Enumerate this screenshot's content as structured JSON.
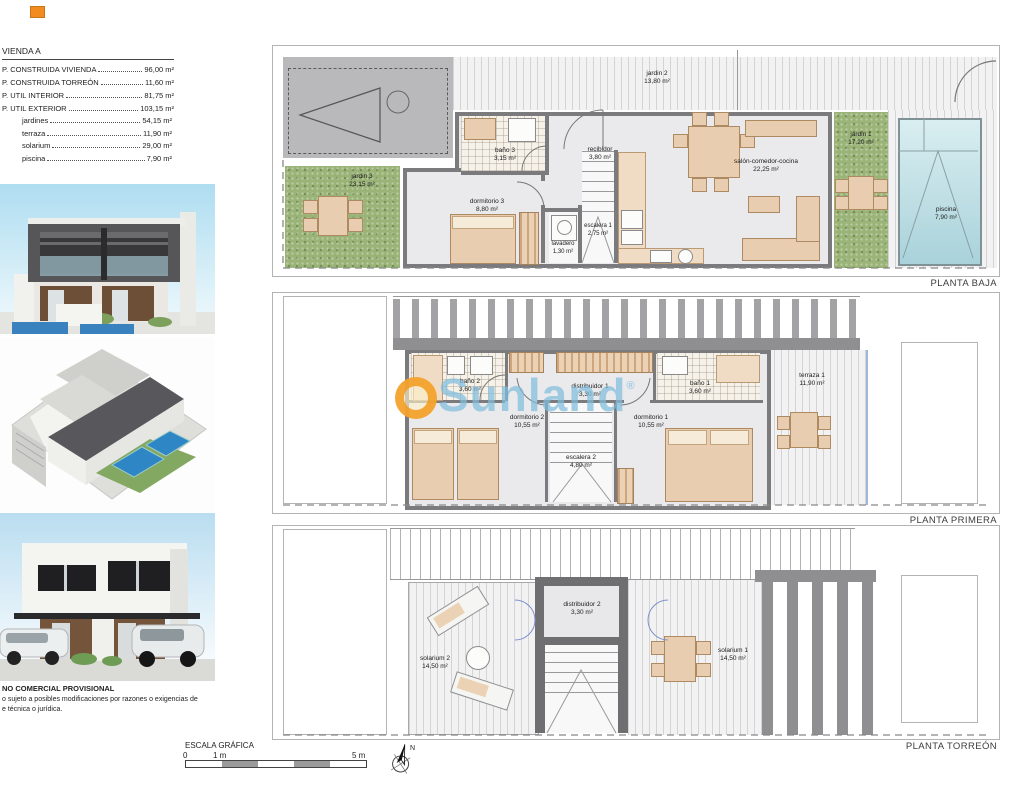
{
  "legend": {
    "title": "VIENDA A",
    "rows": [
      {
        "label": "P. CONSTRUIDA VIVIENDA",
        "value": "96,00 m²"
      },
      {
        "label": "P. CONSTRUIDA TORREÓN",
        "value": "11,60 m²"
      },
      {
        "label": "P. UTIL INTERIOR",
        "value": "81,75 m²"
      },
      {
        "label": "P. UTIL EXTERIOR",
        "value": "103,15 m²"
      }
    ],
    "subrows": [
      {
        "label": "jardines",
        "value": "54,15 m²"
      },
      {
        "label": "terraza",
        "value": "11,90 m²"
      },
      {
        "label": "solarium",
        "value": "29,00 m²"
      },
      {
        "label": "piscina",
        "value": "7,90 m²"
      }
    ]
  },
  "floors": [
    {
      "label": "PLANTA BAJA",
      "rooms": [
        {
          "name": "jardin 2",
          "area": "13,80 m²"
        },
        {
          "name": "jardin 3",
          "area": "23,15 m²"
        },
        {
          "name": "baño 3",
          "area": "3,15 m²"
        },
        {
          "name": "recibidor",
          "area": "3,80 m²"
        },
        {
          "name": "dormitorio 3",
          "area": "8,80 m²"
        },
        {
          "name": "lavadero",
          "area": "1,30 m²"
        },
        {
          "name": "escalera 1",
          "area": "2,75 m²"
        },
        {
          "name": "salón-comedor-cocina",
          "area": "22,25 m²"
        },
        {
          "name": "jardin 1",
          "area": "17,20 m²"
        },
        {
          "name": "piscina",
          "area": "7,90 m²"
        }
      ]
    },
    {
      "label": "PLANTA PRIMERA",
      "rooms": [
        {
          "name": "baño 2",
          "area": "3,60 m²"
        },
        {
          "name": "distribuidor 1",
          "area": "3,30 m²"
        },
        {
          "name": "baño 1",
          "area": "3,60 m²"
        },
        {
          "name": "dormitorio 2",
          "area": "10,55 m²"
        },
        {
          "name": "dormitorio 1",
          "area": "10,55 m²"
        },
        {
          "name": "escalera 2",
          "area": "4,80 m²"
        },
        {
          "name": "terraza 1",
          "area": "11,90 m²"
        }
      ]
    },
    {
      "label": "PLANTA TORREÓN",
      "rooms": [
        {
          "name": "solarium 2",
          "area": "14,50 m²"
        },
        {
          "name": "distribuidor 2",
          "area": "3,30 m²"
        },
        {
          "name": "solarium 1",
          "area": "14,50 m²"
        }
      ]
    }
  ],
  "watermark": {
    "text": "Sunland",
    "registered": "®"
  },
  "scalebar": {
    "title": "ESCALA GRÁFICA",
    "tick0": "0",
    "tick1": "1 m",
    "tick5": "5 m"
  },
  "compass": {
    "north": "N"
  },
  "disclaimer": {
    "line1": "NO COMERCIAL PROVISIONAL",
    "line2": "o sujeto a posibles modificaciones por razones o exigencias de",
    "line3": "e técnica o jurídica."
  },
  "colors": {
    "wall": "#7b7b7d",
    "floor": "#eaeaec",
    "furniture": "#e9cdb0",
    "grass": "#9ab377",
    "pool": "#bfe0e6",
    "watermark_orange": "#f39c1f",
    "watermark_blue": "#80bcdd",
    "door_blue": "#8090cc",
    "marker_orange": "#f28c1e"
  }
}
